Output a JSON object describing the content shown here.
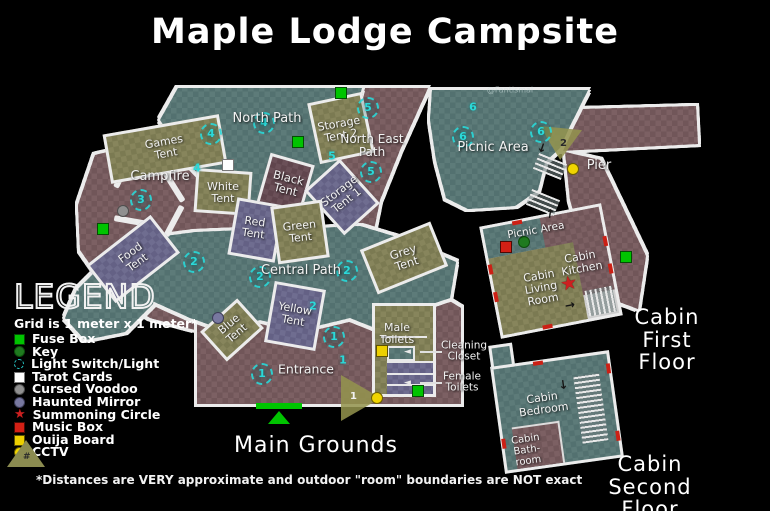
{
  "title": "Maple Lodge Campsite",
  "watermark": "@Fantismal",
  "legend": {
    "heading": "LEGEND",
    "subtitle": "Grid is 1 meter x 1 meter*",
    "items": [
      {
        "key": "fuse-box",
        "label": "Fuse Box"
      },
      {
        "key": "key",
        "label": "Key"
      },
      {
        "key": "light-switch",
        "label": "Light Switch/Light"
      },
      {
        "key": "tarot-cards",
        "label": "Tarot Cards"
      },
      {
        "key": "cursed-voodoo",
        "label": "Cursed Voodoo"
      },
      {
        "key": "haunted-mirror",
        "label": "Haunted Mirror"
      },
      {
        "key": "summoning-circle",
        "label": "Summoning Circle"
      },
      {
        "key": "music-box",
        "label": "Music Box"
      },
      {
        "key": "ouija-board",
        "label": "Ouija Board"
      },
      {
        "key": "cctv",
        "label": "CCTV"
      }
    ],
    "camera_symbol": "#"
  },
  "footnote": "*Distances are VERY approximate and outdoor \"room\" boundaries are NOT exact",
  "areas": {
    "main_grounds": "Main Grounds",
    "cabin_first_floor": "Cabin First Floor",
    "cabin_second_floor": "Cabin Second Floor"
  },
  "regions": {
    "games_tent": "Games\nTent",
    "north_path": "North Path",
    "campfire": "Campfire",
    "white_tent": "White\nTent",
    "black_tent": "Black\nTent",
    "storage_tent_2": "Storage\nTent 2",
    "storage_tent_1": "Storage\nTent 1",
    "north_east_path": "North East\nPath",
    "picnic_area": "Picnic Area",
    "pier": "Pier",
    "red_tent": "Red\nTent",
    "green_tent": "Green\nTent",
    "grey_tent": "Grey\nTent",
    "central_path": "Central Path",
    "food_tent": "Food\nTent",
    "blue_tent": "Blue\nTent",
    "yellow_tent": "Yellow\nTent",
    "entrance": "Entrance",
    "male_toilets": "Male\nToilets",
    "cabin_picnic_area": "Picnic Area",
    "cabin_living_room": "Cabin\nLiving\nRoom",
    "cabin_kitchen": "Cabin\nKitchen",
    "cabin_bedroom": "Cabin\nBedroom",
    "cabin_bathroom": "Cabin\nBath-\nroom"
  },
  "callouts": {
    "cleaning_closet": "Cleaning\nCloset",
    "female_toilets": "Female\nToilets"
  },
  "lights": [
    "4",
    "4",
    "3",
    "5",
    "5",
    "6",
    "6",
    "2",
    "2",
    "2",
    "1",
    "1",
    "4",
    "5",
    "6",
    "2",
    "1"
  ],
  "cameras": {
    "pier": "2",
    "entrance": "1"
  },
  "icons": {
    "star": "★",
    "arrow_up": "↑",
    "arrow_down": "↓",
    "arrow_right": "→",
    "arrow_left": "◄",
    "hash": "#"
  },
  "colors": {
    "path_teal": "#5d7b79",
    "grounds_mauve": "#7c6063",
    "tent_olive": "#87855c",
    "tent_slate": "#6f6d90",
    "tent_dark": "#6b5058",
    "wall": "#ececec",
    "fuse_box": "#00c400",
    "key": "#1f7a1f",
    "light": "#2bd9d9",
    "tarot": "#ffffff",
    "voodoo": "#909090",
    "mirror": "#7878a0",
    "summoning": "#cc2020",
    "music_box": "#d32015",
    "ouija": "#eccf00",
    "cctv": "#f0d400",
    "camera_cone": "#94944e",
    "entrance_door": "#00c400"
  }
}
